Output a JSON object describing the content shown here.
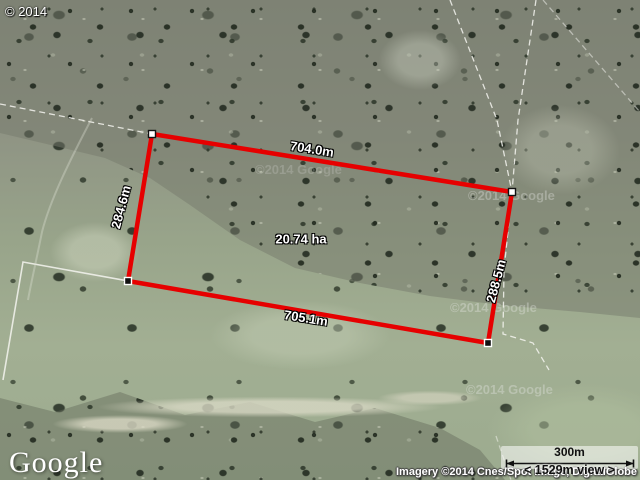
{
  "map": {
    "copyright_overlay": "© 2014",
    "watermark": "©2014 Google",
    "google_logo": "Google",
    "attribution": "Imagery ©2014 Cnes/Spot Image, DigitalGlobe"
  },
  "measurement": {
    "top_edge": "704.0m",
    "left_edge": "284.6m",
    "right_edge": "288.5m",
    "bottom_edge": "705.1m",
    "area": "20.74 ha",
    "outline_color": "#e60000"
  },
  "scale_bar": {
    "distance": "300m",
    "view": "< 1529m view >"
  }
}
